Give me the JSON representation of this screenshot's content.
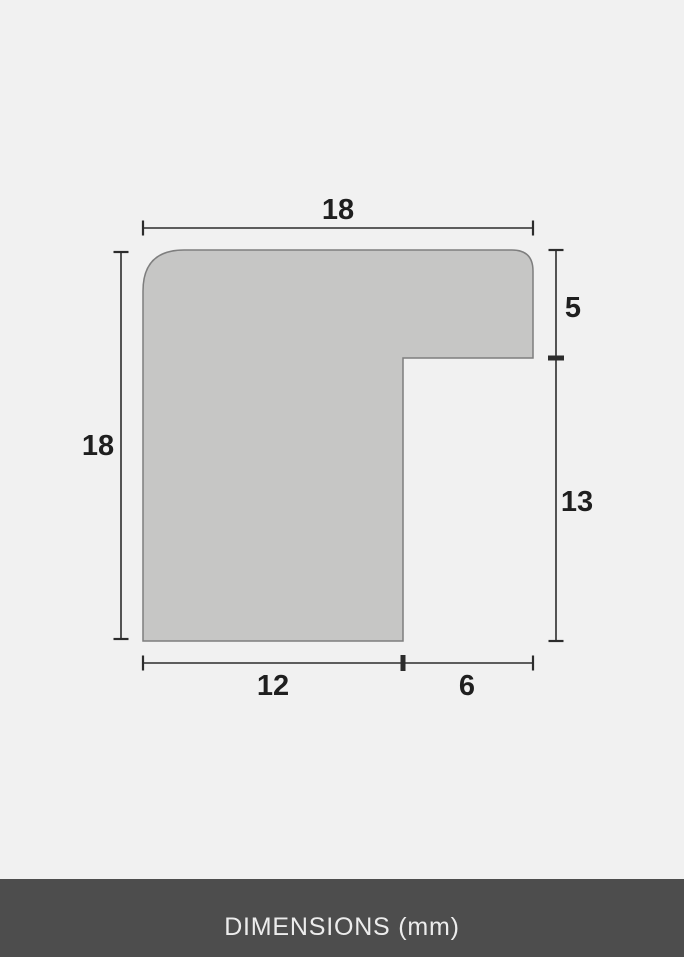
{
  "colors": {
    "background": "#f1f1f1",
    "shape_fill": "#c6c6c5",
    "shape_stroke": "#7e7e7e",
    "dimension_line": "#2c2c2c",
    "label_text": "#1f1f1f",
    "footer_bg": "#4d4d4d",
    "footer_text": "#ececec"
  },
  "diagram": {
    "type": "frame-moulding-profile-cross-section",
    "unit": "mm",
    "dimensions": {
      "top_width": "18",
      "left_height": "18",
      "right_upper": "5",
      "right_lower": "13",
      "bottom_inner": "12",
      "bottom_outer": "6"
    }
  },
  "footer": {
    "label": "DIMENSIONS (mm)"
  }
}
